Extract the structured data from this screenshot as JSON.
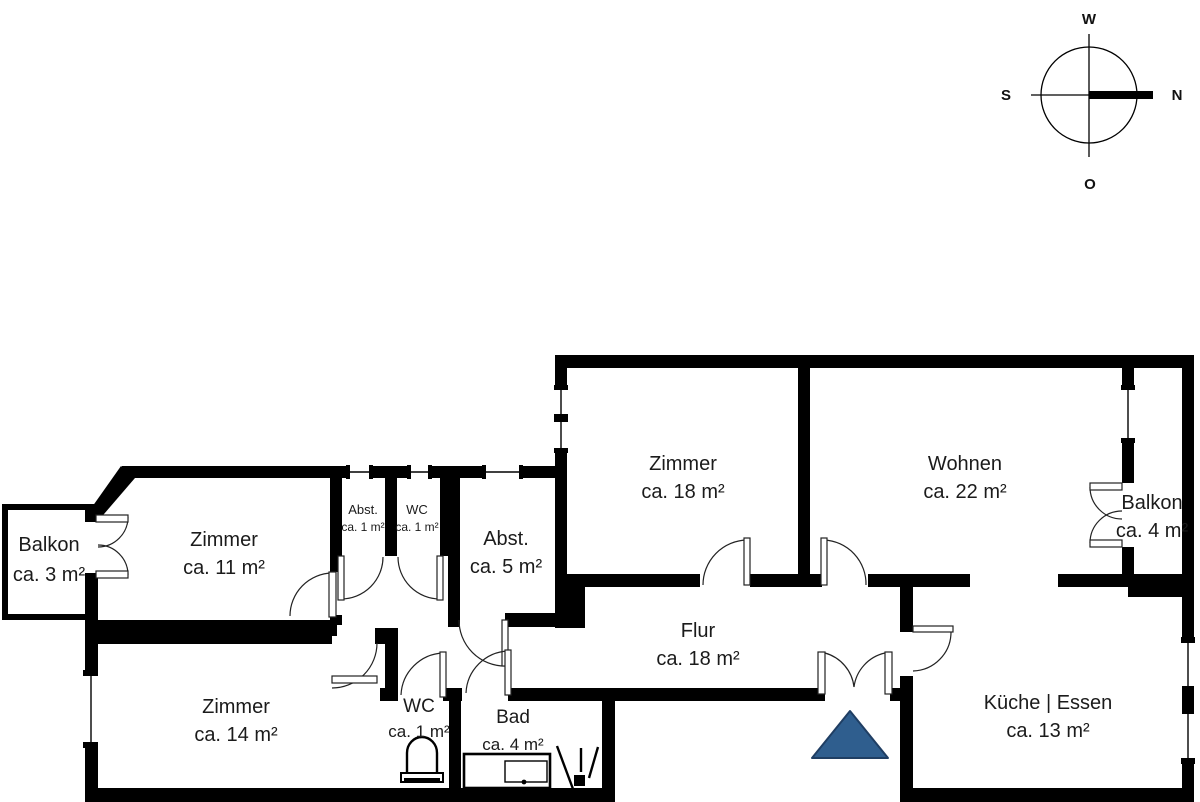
{
  "plan": {
    "rooms": [
      {
        "name": "Balkon",
        "area": "ca. 3 m²"
      },
      {
        "name": "Zimmer",
        "area": "ca. 11 m²"
      },
      {
        "name": "Abst.",
        "area": "ca. 1 m²"
      },
      {
        "name": "WC",
        "area": "ca. 1 m²"
      },
      {
        "name": "Abst.",
        "area": "ca. 5 m²"
      },
      {
        "name": "Zimmer",
        "area": "ca. 18 m²"
      },
      {
        "name": "Wohnen",
        "area": "ca. 22 m²"
      },
      {
        "name": "Balkon",
        "area": "ca. 4 m²"
      },
      {
        "name": "Flur",
        "area": "ca. 18 m²"
      },
      {
        "name": "Zimmer",
        "area": "ca. 14 m²"
      },
      {
        "name": "WC",
        "area": "ca. 1 m²"
      },
      {
        "name": "Bad",
        "area": "ca. 4 m²"
      },
      {
        "name": "Küche | Essen",
        "area": "ca. 13 m²"
      }
    ],
    "compass": {
      "west": "W",
      "north": "N",
      "south": "S",
      "east": "O"
    },
    "colors": {
      "wall": "#000000",
      "entrance_marker_fill": "#2f5e8e",
      "entrance_marker_border": "#1f3e63"
    }
  }
}
